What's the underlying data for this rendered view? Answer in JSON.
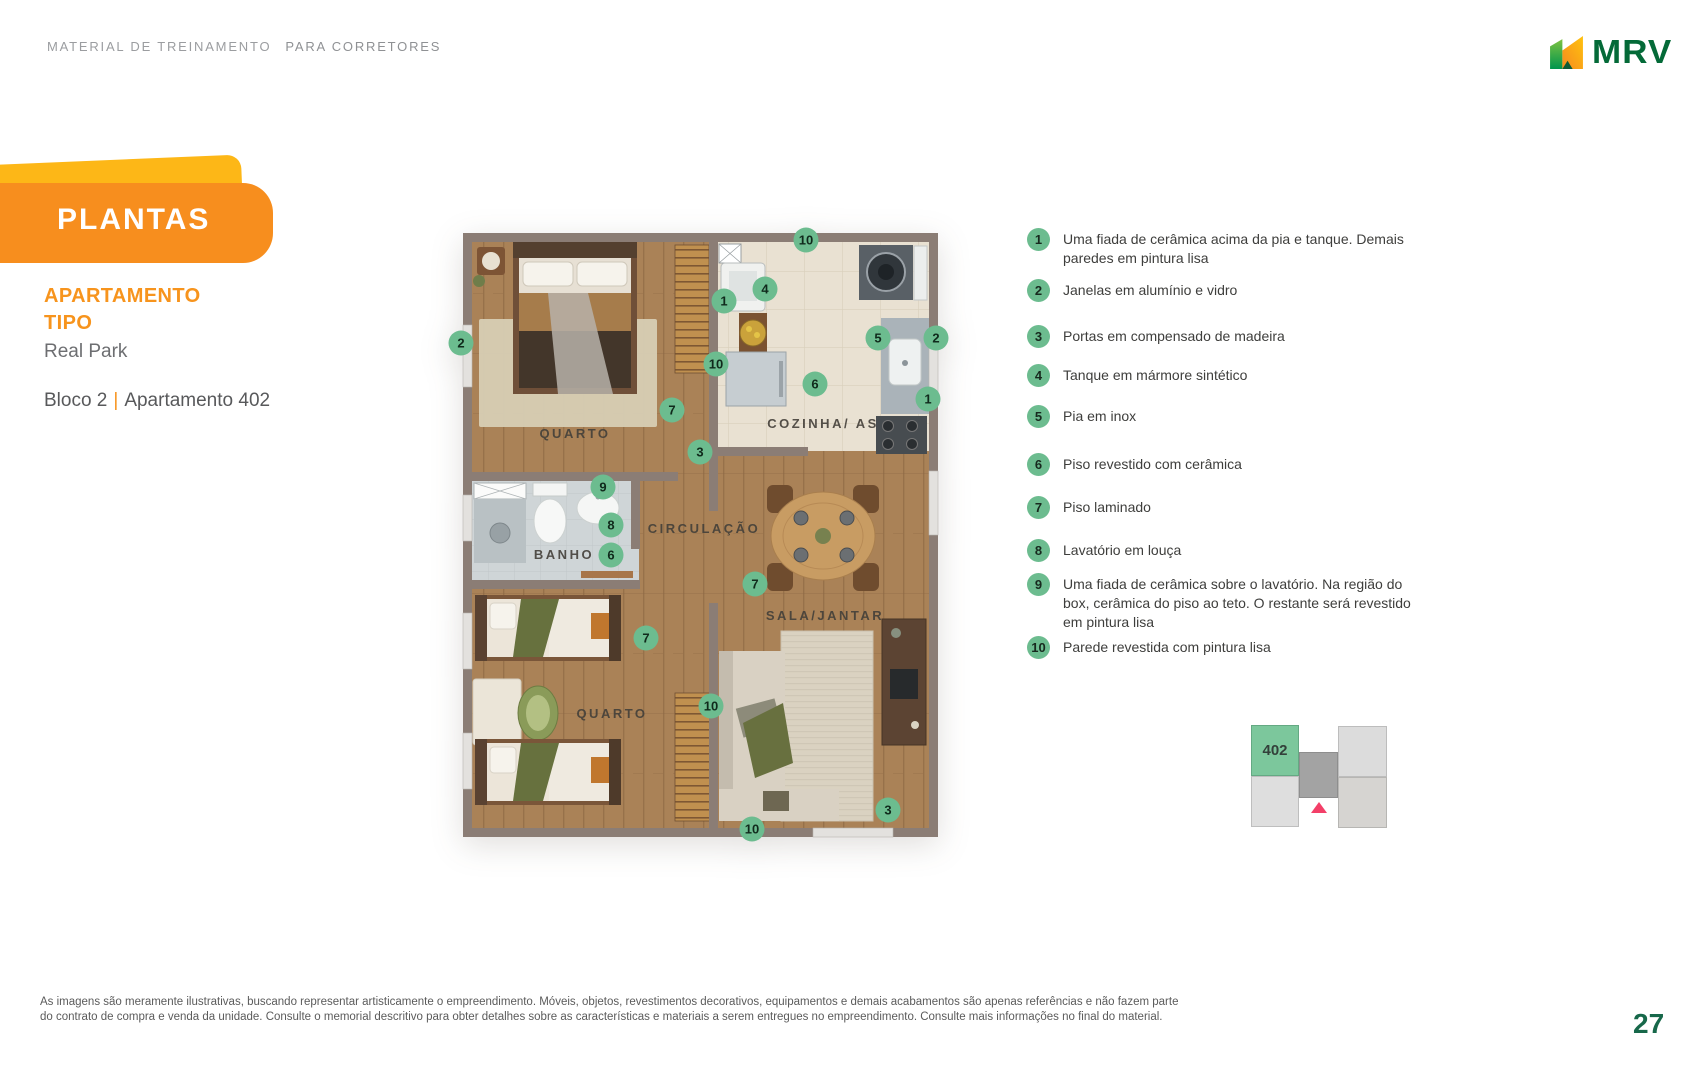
{
  "header": {
    "eyebrow_left": "MATERIAL DE TREINAMENTO",
    "eyebrow_right": "PARA CORRETORES"
  },
  "logo": {
    "text": "MRV"
  },
  "banner": {
    "title": "PLANTAS"
  },
  "sidebar": {
    "subtitle_line1": "APARTAMENTO",
    "subtitle_line2": "TIPO",
    "project": "Real Park",
    "block": "Bloco 2",
    "separator": "|",
    "unit": "Apartamento 402"
  },
  "floor_plan": {
    "rooms": [
      {
        "name": "QUARTO",
        "x": 112,
        "y": 205
      },
      {
        "name": "COZINHA/ AS",
        "x": 360,
        "y": 195
      },
      {
        "name": "CIRCULAÇÃO",
        "x": 241,
        "y": 300
      },
      {
        "name": "BANHO",
        "x": 101,
        "y": 326
      },
      {
        "name": "SALA/JANTAR",
        "x": 362,
        "y": 387
      },
      {
        "name": "QUARTO",
        "x": 149,
        "y": 485
      }
    ],
    "markers": [
      {
        "n": "10",
        "x": 343,
        "y": 7
      },
      {
        "n": "2",
        "x": -2,
        "y": 110
      },
      {
        "n": "1",
        "x": 261,
        "y": 68
      },
      {
        "n": "4",
        "x": 302,
        "y": 56
      },
      {
        "n": "10",
        "x": 253,
        "y": 131
      },
      {
        "n": "6",
        "x": 352,
        "y": 151
      },
      {
        "n": "5",
        "x": 415,
        "y": 105
      },
      {
        "n": "2",
        "x": 473,
        "y": 105
      },
      {
        "n": "1",
        "x": 465,
        "y": 166
      },
      {
        "n": "7",
        "x": 209,
        "y": 177
      },
      {
        "n": "3",
        "x": 237,
        "y": 219
      },
      {
        "n": "9",
        "x": 140,
        "y": 254
      },
      {
        "n": "8",
        "x": 148,
        "y": 292
      },
      {
        "n": "6",
        "x": 148,
        "y": 322
      },
      {
        "n": "7",
        "x": 292,
        "y": 351
      },
      {
        "n": "7",
        "x": 183,
        "y": 405
      },
      {
        "n": "10",
        "x": 248,
        "y": 473
      },
      {
        "n": "3",
        "x": 425,
        "y": 577
      },
      {
        "n": "10",
        "x": 289,
        "y": 596
      }
    ]
  },
  "legend": {
    "items": [
      {
        "num": "1",
        "text": "Uma fiada de cerâmica acima da pia e tanque. Demais paredes em pintura lisa"
      },
      {
        "num": "2",
        "text": "Janelas em alumínio e vidro"
      },
      {
        "num": "3",
        "text": "Portas em compensado de madeira"
      },
      {
        "num": "4",
        "text": "Tanque em mármore sintético"
      },
      {
        "num": "5",
        "text": "Pia em inox"
      },
      {
        "num": "6",
        "text": "Piso revestido com cerâmica"
      },
      {
        "num": "7",
        "text": "Piso laminado"
      },
      {
        "num": "8",
        "text": "Lavatório em louça"
      },
      {
        "num": "9",
        "text": "Uma fiada de cerâmica sobre o lavatório. Na região do box, cerâmica do piso ao teto. O restante será revestido em pintura lisa"
      },
      {
        "num": "10",
        "text": "Parede revestida com pintura lisa"
      }
    ]
  },
  "mini_map": {
    "unit_label": "402"
  },
  "footer": {
    "disclaimer_line1": "As imagens são meramente ilustrativas, buscando representar artisticamente o empreendimento. Móveis, objetos, revestimentos decorativos, equipamentos e demais acabamentos são apenas referências e não fazem parte",
    "disclaimer_line2": "do contrato de compra e venda da unidade. Consulte o memorial descritivo para obter detalhes sobre as características e materiais a serem entregues no empreendimento. Consulte mais informações no final do material.",
    "page_number": "27"
  },
  "colors": {
    "accent_orange": "#F78E1E",
    "accent_yellow": "#FDB717",
    "legend_green": "#6CBC8F",
    "mrv_green": "#046A38",
    "page_number_green": "#17684A",
    "minimap_highlight_green": "#7CC79C",
    "minimap_pointer_pink": "#F33F68",
    "wall_taupe": "#8B7D75"
  }
}
